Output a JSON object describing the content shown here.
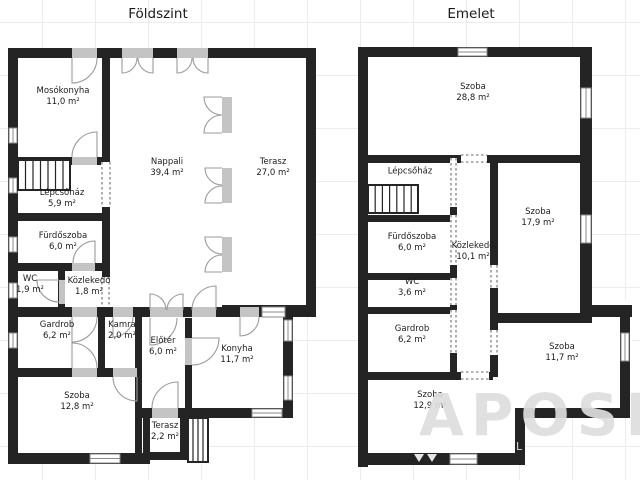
{
  "page": {
    "background": "#ffffff",
    "grid_color": "#ececec"
  },
  "colors": {
    "wall": "#242424",
    "door_opening": "#c4c4c4",
    "door_arc": "#9b9b9b",
    "window_frame": "#8a8a8a",
    "dashed_opening": "#9a9a9a",
    "label_text": "#1c1c1c",
    "watermark": "#dedede"
  },
  "floors": [
    {
      "id": "foldszint",
      "title": "Földszint",
      "title_x": 158,
      "title_y": 6,
      "rooms": [
        {
          "name": "Mosókonyha",
          "area": "11,0 m²",
          "x": 63,
          "y": 97
        },
        {
          "name": "Nappali",
          "area": "39,4 m²",
          "x": 167,
          "y": 168
        },
        {
          "name": "Terasz",
          "area": "27,0 m²",
          "x": 273,
          "y": 168
        },
        {
          "name": "Lépcsőház",
          "area": "5,9 m²",
          "x": 62,
          "y": 199
        },
        {
          "name": "Fürdőszoba",
          "area": "6,0 m²",
          "x": 63,
          "y": 242
        },
        {
          "name": "WC",
          "area": "1,9 m²",
          "x": 30,
          "y": 285
        },
        {
          "name": "Közlekedő",
          "area": "1,8 m²",
          "x": 89,
          "y": 287
        },
        {
          "name": "Gardrob",
          "area": "6,2 m²",
          "x": 57,
          "y": 331
        },
        {
          "name": "Kamra",
          "area": "2,0 m²",
          "x": 122,
          "y": 331
        },
        {
          "name": "Előtér",
          "area": "6,0 m²",
          "x": 163,
          "y": 347
        },
        {
          "name": "Konyha",
          "area": "11,7 m²",
          "x": 237,
          "y": 355
        },
        {
          "name": "Szoba",
          "area": "12,8 m²",
          "x": 77,
          "y": 402
        },
        {
          "name": "Terasz",
          "area": "2,2 m²",
          "x": 165,
          "y": 432
        }
      ]
    },
    {
      "id": "emelet",
      "title": "Emelet",
      "title_x": 471,
      "title_y": 6,
      "rooms": [
        {
          "name": "Szoba",
          "area": "28,8 m²",
          "x": 473,
          "y": 93
        },
        {
          "name": "Lépcsőház",
          "area": null,
          "x": 410,
          "y": 172
        },
        {
          "name": "Fürdőszoba",
          "area": "6,0 m²",
          "x": 412,
          "y": 243
        },
        {
          "name": "Közlekedő",
          "area": "10,1 m²",
          "x": 473,
          "y": 252
        },
        {
          "name": "Szoba",
          "area": "17,9 m²",
          "x": 538,
          "y": 218
        },
        {
          "name": "WC",
          "area": "3,6 m²",
          "x": 412,
          "y": 288
        },
        {
          "name": "Gardrob",
          "area": "6,2 m²",
          "x": 412,
          "y": 335
        },
        {
          "name": "Szoba",
          "area": "11,7 m²",
          "x": 562,
          "y": 353
        },
        {
          "name": "Szoba",
          "area": "12,9 m²",
          "x": 430,
          "y": 401
        }
      ]
    }
  ],
  "watermark": {
    "text": "APOSI",
    "small_text": "L"
  }
}
